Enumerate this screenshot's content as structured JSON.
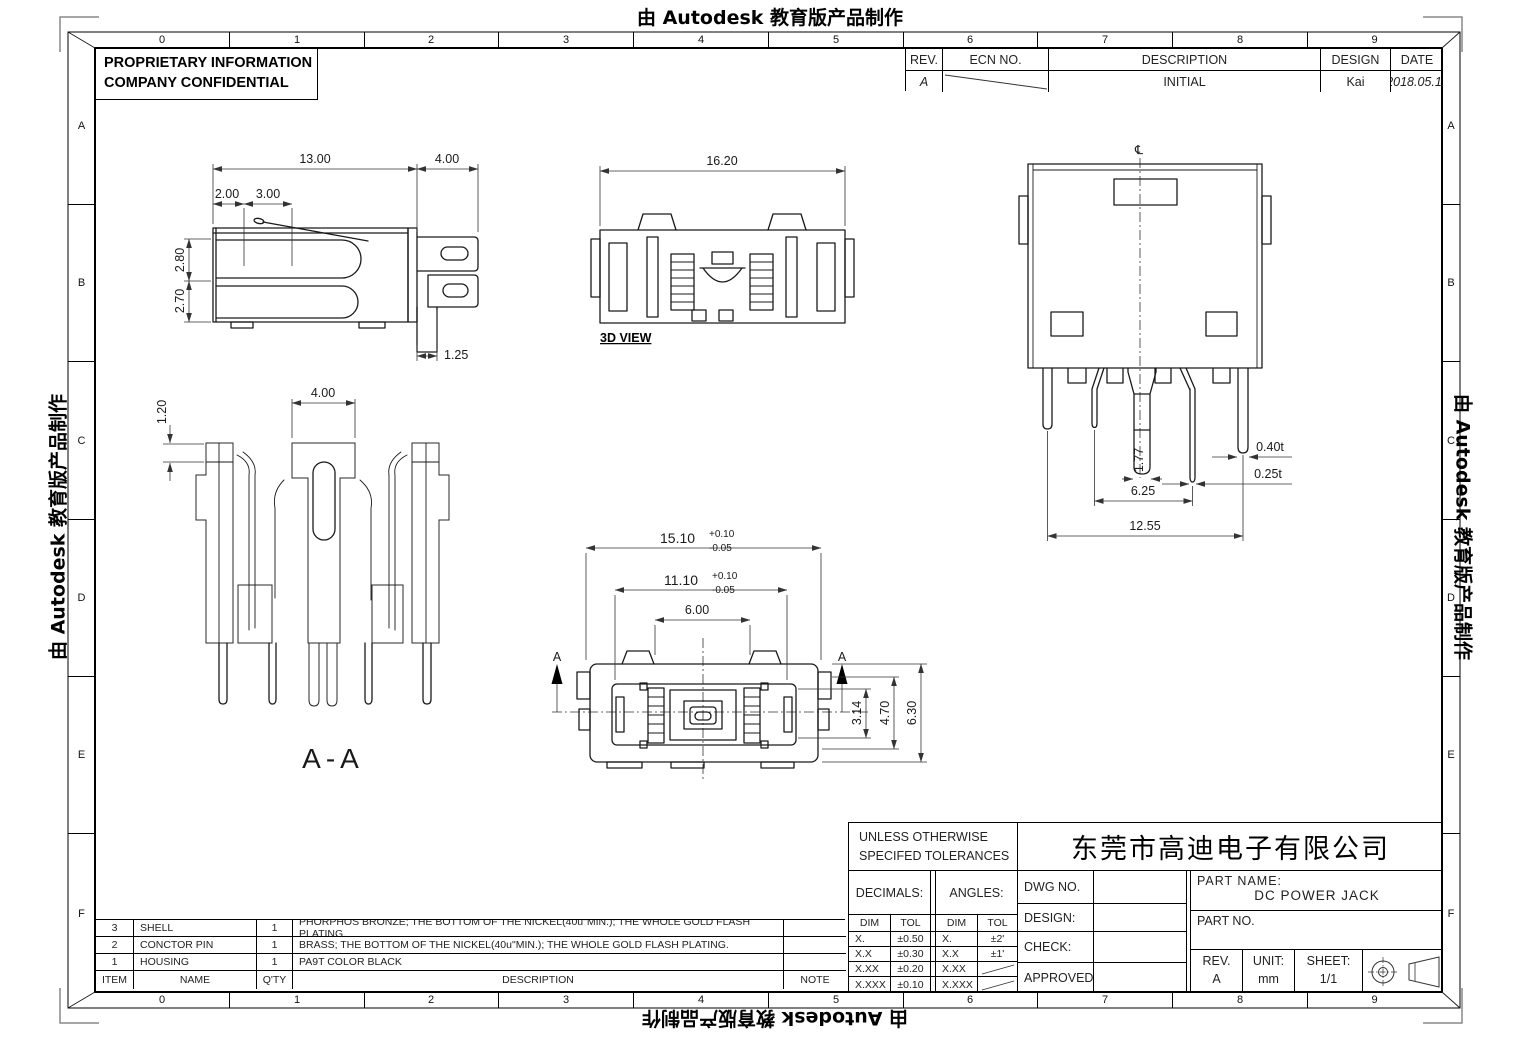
{
  "watermark": {
    "text": "由 Autodesk 教育版产品制作"
  },
  "frame": {
    "cols": [
      "0",
      "1",
      "2",
      "3",
      "4",
      "5",
      "6",
      "7",
      "8",
      "9"
    ],
    "rows": [
      "A",
      "B",
      "C",
      "D",
      "E",
      "F"
    ]
  },
  "proprietary": {
    "line1": "PROPRIETARY INFORMATION",
    "line2": "COMPANY CONFIDENTIAL"
  },
  "revision_table": {
    "headers": {
      "rev": "REV.",
      "ecn": "ECN NO.",
      "description": "DESCRIPTION",
      "design": "DESIGN",
      "date": "DATE"
    },
    "rows": [
      {
        "rev": "A",
        "ecn": "",
        "description": "INITIAL",
        "design": "Kai",
        "date": "2018.05.11"
      }
    ]
  },
  "views": {
    "side": {
      "d13": "13.00",
      "d4": "4.00",
      "d2": "2.00",
      "d3": "3.00",
      "d280": "2.80",
      "d270": "2.70",
      "d125": "1.25"
    },
    "front": {
      "label": "3D VIEW",
      "d1620": "16.20"
    },
    "top": {
      "centerline": "℄",
      "d040": "0.40t",
      "d025": "0.25t",
      "d177": "1.77",
      "d625": "6.25",
      "d1255": "12.55"
    },
    "section": {
      "label": "A-A",
      "d400": "4.00",
      "d120": "1.20"
    },
    "bottom": {
      "marker": "A",
      "d1510": "15.10",
      "d1510_up": "+0.10",
      "d1510_dn": "-0.05",
      "d1110": "11.10",
      "d1110_up": "+0.10",
      "d1110_dn": "-0.05",
      "d600": "6.00",
      "d314": "3.14",
      "d470": "4.70",
      "d630": "6.30"
    }
  },
  "bom": {
    "headers": {
      "item": "ITEM",
      "name": "NAME",
      "qty": "Q'TY",
      "description": "DESCRIPTION",
      "note": "NOTE"
    },
    "rows": [
      {
        "item": "3",
        "name": "SHELL",
        "qty": "1",
        "description": "PHORPHOS BRONZE; THE BOTTOM OF THE NICKEL(40u\"MIN.); THE WHOLE GOLD FLASH PLATING.",
        "note": ""
      },
      {
        "item": "2",
        "name": "CONCTOR PIN",
        "qty": "1",
        "description": "BRASS; THE BOTTOM OF THE NICKEL(40u\"MIN.); THE WHOLE GOLD FLASH PLATING.",
        "note": ""
      },
      {
        "item": "1",
        "name": "HOUSING",
        "qty": "1",
        "description": "PA9T COLOR BLACK",
        "note": ""
      }
    ]
  },
  "title_block": {
    "tol_title1": "UNLESS OTHERWISE",
    "tol_title2": "SPECIFED TOLERANCES",
    "decimals_label": "DECIMALS:",
    "angles_label": "ANGLES:",
    "dim_header": "DIM",
    "tol_header": "TOL",
    "dec_rows": [
      {
        "dim": "X.",
        "tol": "±0.50"
      },
      {
        "dim": "X.X",
        "tol": "±0.30"
      },
      {
        "dim": "X.XX",
        "tol": "±0.20"
      },
      {
        "dim": "X.XXX",
        "tol": "±0.10"
      }
    ],
    "ang_rows": [
      {
        "dim": "X.",
        "tol": "±2'"
      },
      {
        "dim": "X.X",
        "tol": "±1'"
      },
      {
        "dim": "X.XX",
        "tol": ""
      },
      {
        "dim": "X.XXX",
        "tol": ""
      }
    ],
    "company": "东莞市高迪电子有限公司",
    "dwg_no_label": "DWG NO.",
    "design_label": "DESIGN:",
    "check_label": "CHECK:",
    "approved_label": "APPROVED",
    "part_name_label": "PART NAME:",
    "part_name": "DC POWER JACK",
    "part_no_label": "PART NO.",
    "rev_label": "REV.",
    "rev_value": "A",
    "unit_label": "UNIT:",
    "unit_value": "mm",
    "sheet_label": "SHEET:",
    "sheet_value": "1/1"
  },
  "colors": {
    "line": "#1a1a1a",
    "dim": "#333333"
  }
}
